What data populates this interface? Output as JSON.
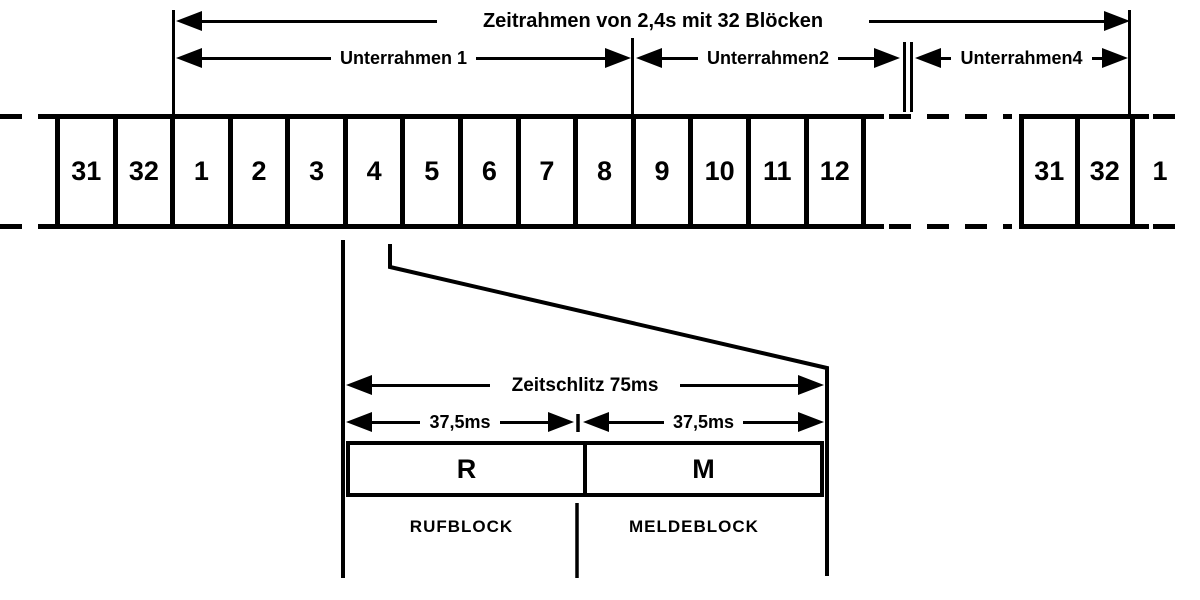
{
  "diagram": {
    "frame_label": "Zeitrahmen von 2,4s mit 32 Blöcken",
    "subframes": [
      {
        "label": "Unterrahmen 1"
      },
      {
        "label": "Unterrahmen2"
      },
      {
        "label": "Unterrahmen4"
      }
    ],
    "blocks_main": [
      "31",
      "32",
      "1",
      "2",
      "3",
      "4",
      "5",
      "6",
      "7",
      "8",
      "9",
      "10",
      "11",
      "12"
    ],
    "blocks_right": [
      "31",
      "32"
    ],
    "block_after_right": "1",
    "detail": {
      "slot_label": "Zeitschlitz 75ms",
      "half_left_label": "37,5ms",
      "half_right_label": "37,5ms",
      "r_letter": "R",
      "m_letter": "M",
      "r_name": "RUFBLOCK",
      "m_name": "MELDEBLOCK"
    },
    "colors": {
      "ink": "#000000",
      "background": "#ffffff"
    }
  }
}
